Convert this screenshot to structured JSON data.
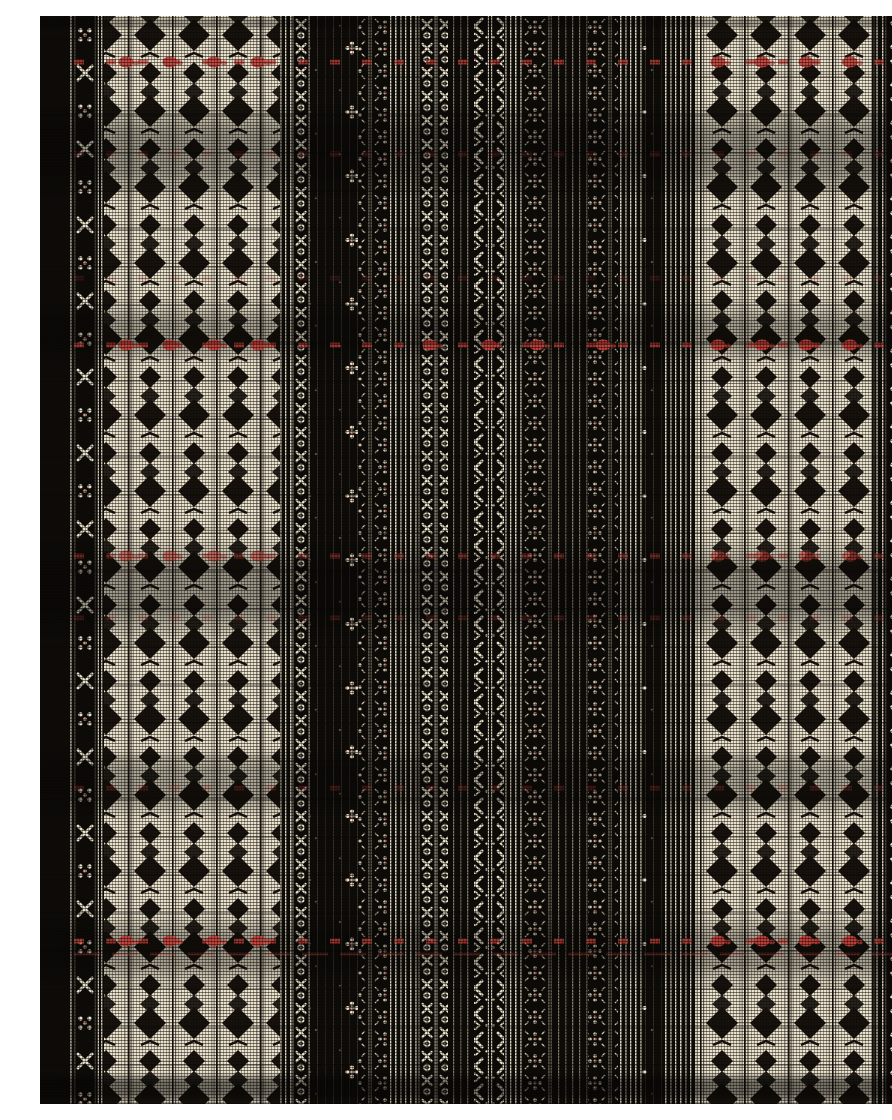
{
  "image": {
    "subject": "black and cream woven plaid textile with diamond motif stripes and red accent threads",
    "width": 892,
    "height": 1088
  },
  "palette": {
    "black": "#0d0b08",
    "ink": "#17120d",
    "cream": "#e9e1cb",
    "cream_dim": "#c9c0a9",
    "pink": "#d79a88",
    "red": "#c7413a"
  },
  "fabric": {
    "zones": [
      {
        "name": "left-selvage",
        "x": 0,
        "w": 28,
        "type": "selvage"
      },
      {
        "name": "left-border-lines",
        "x": 28,
        "w": 6,
        "type": "pinstripes"
      },
      {
        "name": "left-guard-band",
        "x": 34,
        "w": 30,
        "type": "guard"
      },
      {
        "name": "left-diamond-panel",
        "x": 64,
        "w": 176,
        "type": "diamonds"
      },
      {
        "name": "field-lines-1",
        "x": 240,
        "w": 12,
        "type": "pinstripes"
      },
      {
        "name": "chain-band-1",
        "x": 252,
        "w": 18,
        "type": "ornate_bright"
      },
      {
        "name": "sparse-band-1",
        "x": 270,
        "w": 48,
        "type": "sparse"
      },
      {
        "name": "floral-band-1",
        "x": 318,
        "w": 30,
        "type": "ornate_med"
      },
      {
        "name": "field-lines-2",
        "x": 348,
        "w": 30,
        "type": "pinstripes"
      },
      {
        "name": "chain-band-2",
        "x": 378,
        "w": 30,
        "type": "ornate_bright"
      },
      {
        "name": "field-lines-3",
        "x": 408,
        "w": 26,
        "type": "pinstripes_dark"
      },
      {
        "name": "x-chain-band",
        "x": 434,
        "w": 30,
        "type": "ornate_xchain"
      },
      {
        "name": "field-lines-4",
        "x": 464,
        "w": 18,
        "type": "pinstripes"
      },
      {
        "name": "floral-band-2",
        "x": 482,
        "w": 32,
        "type": "ornate_med"
      },
      {
        "name": "field-lines-5",
        "x": 514,
        "w": 34,
        "type": "pinstripes_dark"
      },
      {
        "name": "floral-band-3",
        "x": 548,
        "w": 30,
        "type": "ornate_med"
      },
      {
        "name": "field-lines-6",
        "x": 578,
        "w": 24,
        "type": "pinstripes"
      },
      {
        "name": "sparse-band-2",
        "x": 602,
        "w": 22,
        "type": "sparse"
      },
      {
        "name": "field-lines-7",
        "x": 624,
        "w": 32,
        "type": "pinstripes"
      },
      {
        "name": "right-diamond-panel",
        "x": 656,
        "w": 176,
        "type": "diamonds"
      },
      {
        "name": "right-guard-band",
        "x": 832,
        "w": 42,
        "type": "guard_wide"
      },
      {
        "name": "right-selvage",
        "x": 874,
        "w": 18,
        "type": "selvage"
      }
    ],
    "blob_groups": {
      "panels": [
        86,
        130,
        174,
        218,
        678,
        722,
        766,
        810
      ],
      "all": [
        86,
        130,
        174,
        218,
        390,
        449,
        497,
        563,
        678,
        722,
        766,
        810
      ]
    },
    "red_rows": [
      {
        "y": 46,
        "opacity": 0.95,
        "blobs": "panels"
      },
      {
        "y": 138,
        "opacity": 0.3
      },
      {
        "y": 262,
        "opacity": 0.22
      },
      {
        "y": 329,
        "opacity": 0.95,
        "blobs": "all"
      },
      {
        "y": 540,
        "opacity": 0.65,
        "blobs": "panels"
      },
      {
        "y": 602,
        "opacity": 0.3
      },
      {
        "y": 772,
        "opacity": 0.33
      },
      {
        "y": 925,
        "opacity": 0.95,
        "blobs": "panels"
      },
      {
        "y": 938,
        "opacity": 0.5,
        "thin": true
      }
    ],
    "shade_bands": [
      {
        "y": 0,
        "h": 14,
        "opacity": 0.3
      },
      {
        "y": 86,
        "h": 98,
        "opacity": 0.33
      },
      {
        "y": 286,
        "h": 62,
        "opacity": 0.3
      },
      {
        "y": 522,
        "h": 104,
        "opacity": 0.33
      },
      {
        "y": 732,
        "h": 70,
        "opacity": 0.27
      },
      {
        "y": 898,
        "h": 72,
        "opacity": 0.3
      },
      {
        "y": 1056,
        "h": 32,
        "opacity": 0.5
      }
    ]
  }
}
